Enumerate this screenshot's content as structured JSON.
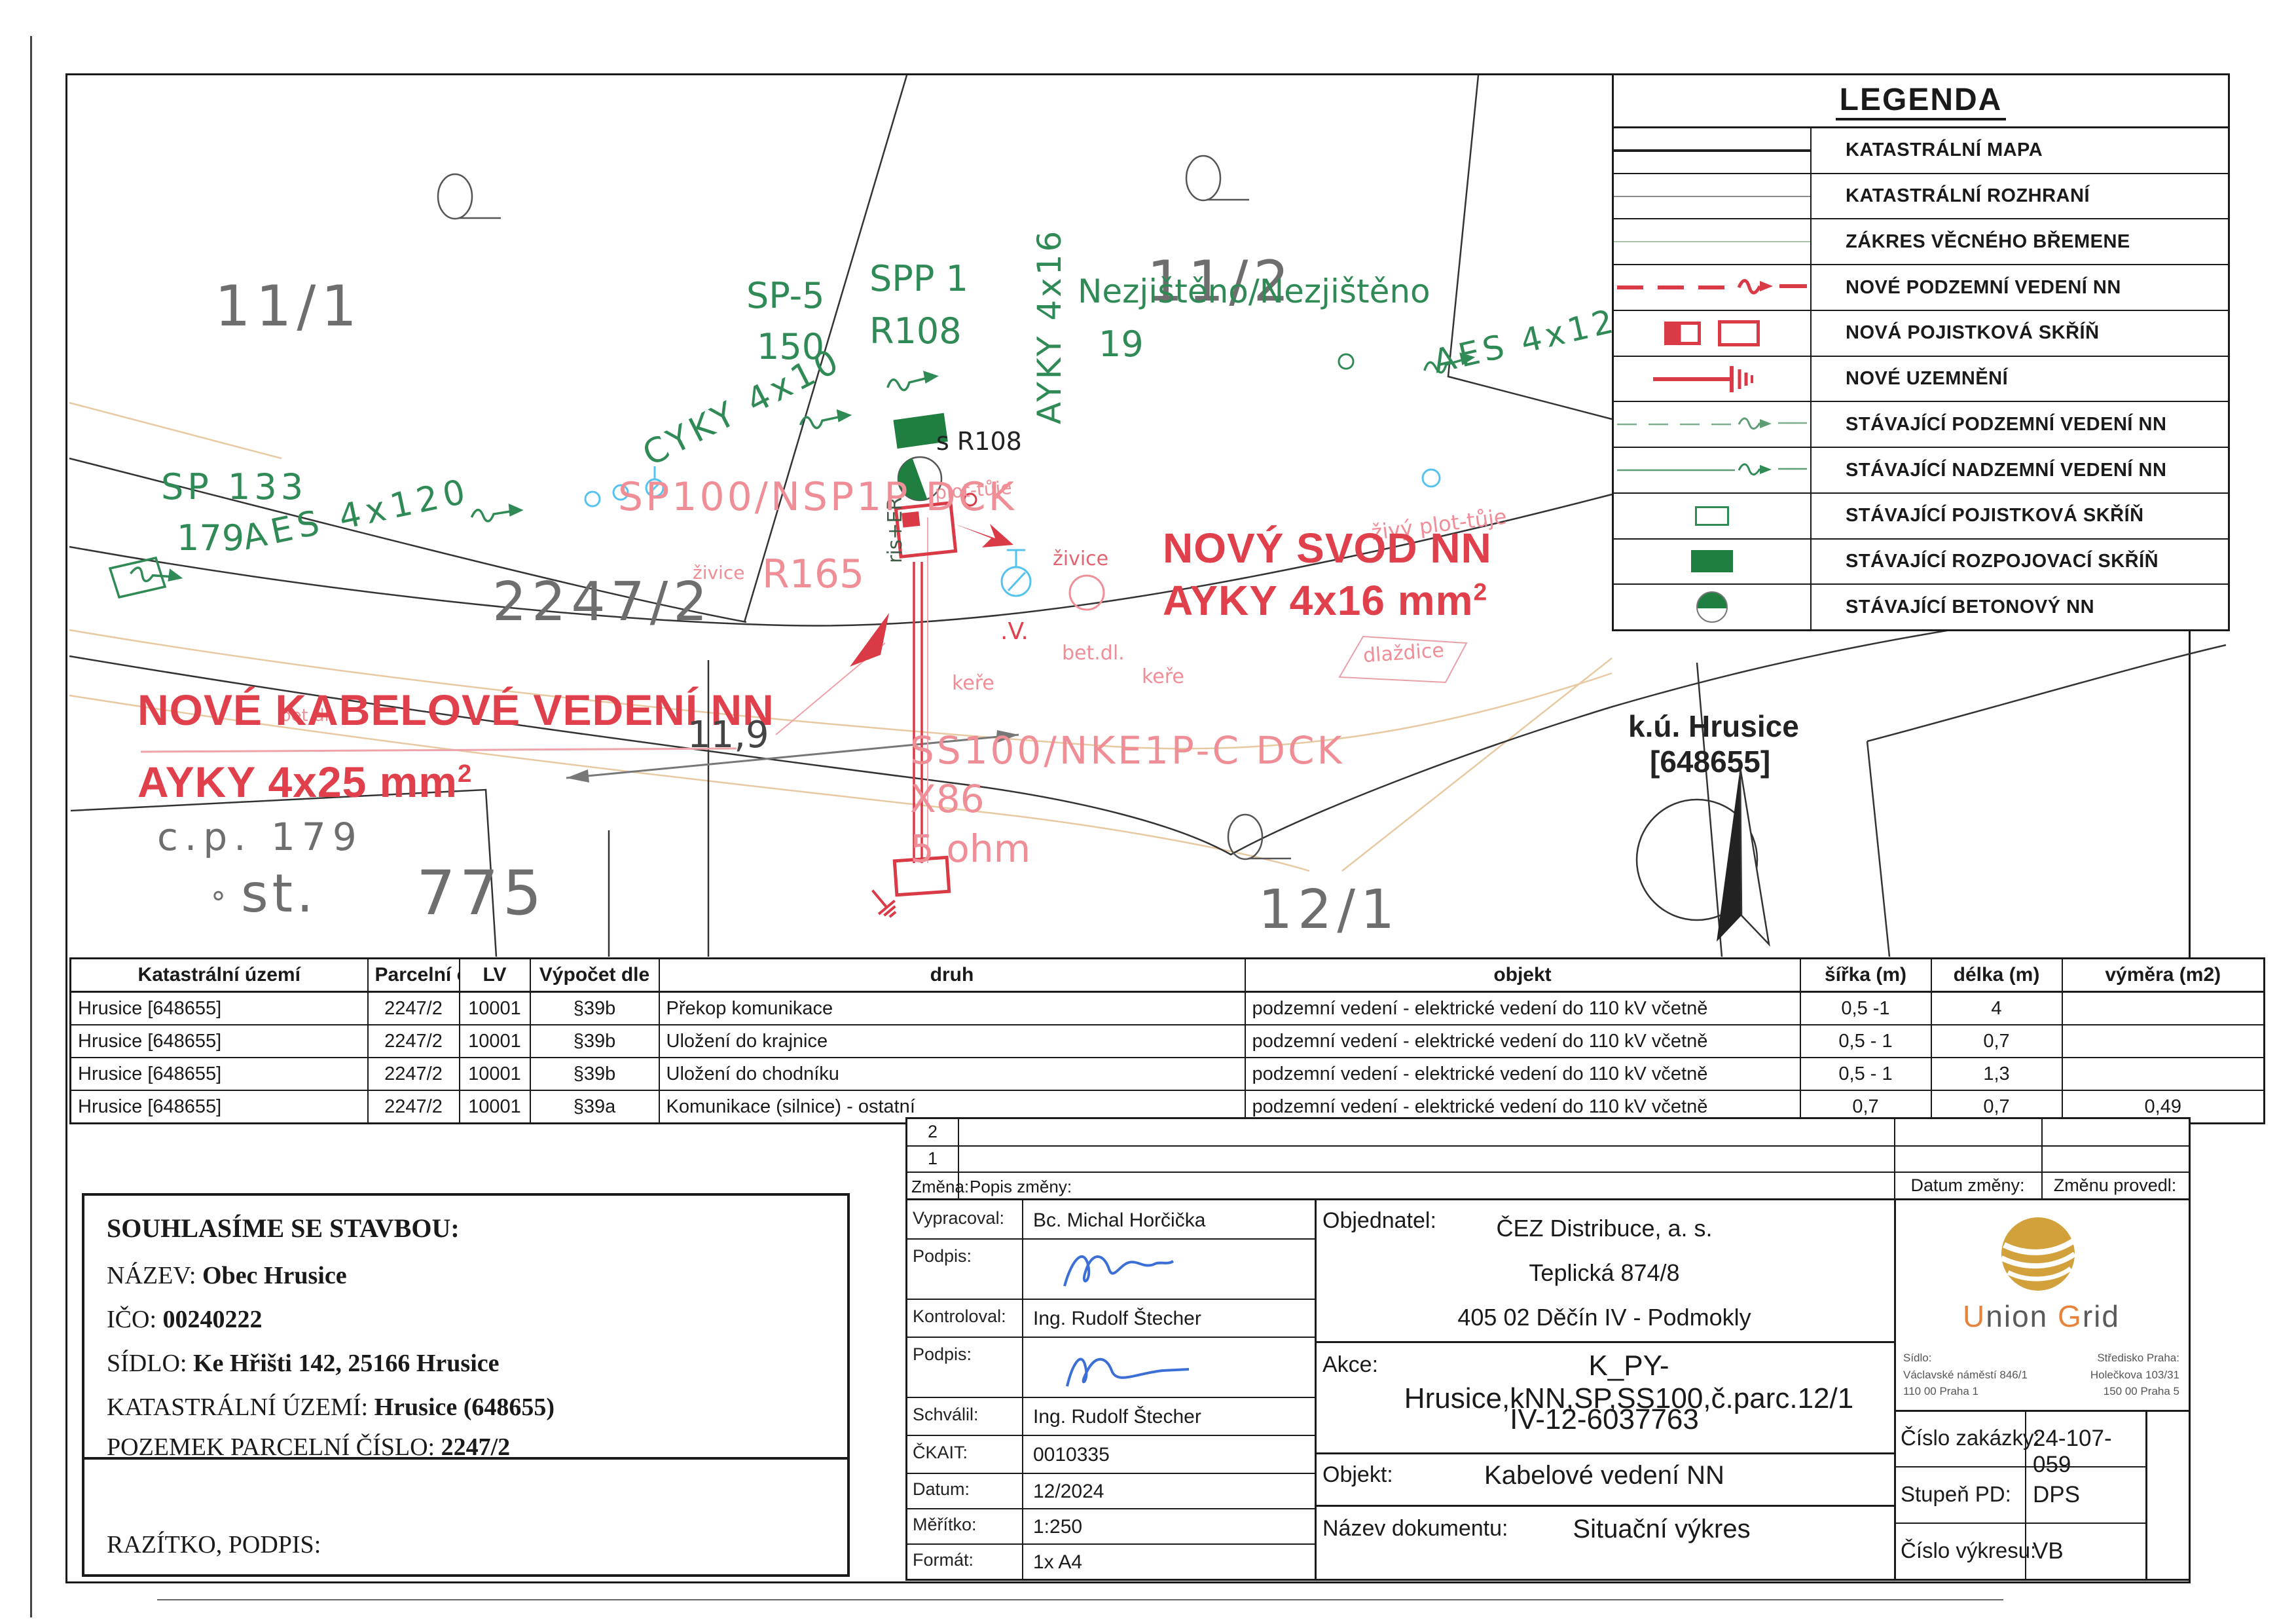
{
  "colors": {
    "new_red": "#d93a46",
    "existing_green": "#2f8a56",
    "pink_note": "#ef8e96",
    "annotation_red": "#e0404b",
    "signature_blue": "#3b6fd6",
    "logo_gold": "#d2a13c",
    "logo_orange": "#e8833a"
  },
  "legend": {
    "title": "LEGENDA",
    "items": [
      {
        "label": "KATASTRÁLNÍ MAPA",
        "symbol": "black-solid-line"
      },
      {
        "label": "KATASTRÁLNÍ ROZHRANÍ",
        "symbol": "gray-thin-line"
      },
      {
        "label": "ZÁKRES VĚCNÉHO BŘEMENE",
        "symbol": "light-green-line"
      },
      {
        "label": "NOVÉ PODZEMNÍ VEDENÍ NN",
        "symbol": "red-dashed-arrow-line"
      },
      {
        "label": "NOVÁ POJISTKOVÁ SKŘÍŇ",
        "symbol": "red-boxes"
      },
      {
        "label": "NOVÉ UZEMNĚNÍ",
        "symbol": "red-ground-symbol"
      },
      {
        "label": "STÁVAJÍCÍ PODZEMNÍ VEDENÍ NN",
        "symbol": "green-dashed-arrow-line"
      },
      {
        "label": "STÁVAJÍCÍ NADZEMNÍ VEDENÍ NN",
        "symbol": "green-solid-arrow-line"
      },
      {
        "label": "STÁVAJÍCÍ POJISTKOVÁ SKŘÍŇ",
        "symbol": "green-outline-box"
      },
      {
        "label": "STÁVAJÍCÍ ROZPOJOVACÍ SKŘÍŇ",
        "symbol": "green-filled-box"
      },
      {
        "label": "STÁVAJÍCÍ BETONOVÝ NN",
        "symbol": "green-half-circle"
      }
    ]
  },
  "map": {
    "parcels": {
      "p11_1": "11/1",
      "p11_2": "11/2",
      "p2247_2": "2247/2",
      "p12_1": "12/1",
      "cp179": "c.p. 179",
      "deg": "°",
      "st": "st.",
      "st775": "775"
    },
    "green": {
      "sp133": "SP 133",
      "n179": "179",
      "aes4x120": "AES 4x120",
      "cyky": "CYKY 4x10",
      "sp5": "SP-5",
      "n150": "150",
      "spp1": "SPP 1",
      "r108": "R108",
      "ayky4x16_v": "AYKY 4x16",
      "nezjisteno": "Nezjištěno/Nezjištěno",
      "n19": "19",
      "aes4x12": "AES 4x12",
      "riser": "ris+ER",
      "s_r108": "s R108"
    },
    "pink": {
      "sp100": "SP100/NSP1P DCK",
      "r165": "R165",
      "zivice1": "živice",
      "zivice2": "živice",
      "plot_tuje1": "plot-tůje",
      "plot_tuje2": "živý plot-tůje",
      "betdl1": "bet.dl.",
      "betdl2": "bet.dl.",
      "kere1": "keře",
      "kere2": "keře",
      "dlazdice": "dlaždice",
      "ss100": "SS100/NKE1P-C DCK",
      "x86": "X86",
      "ohm": "5 ohm",
      "v_mark": ".V."
    },
    "red": {
      "novy_svod_1": "NOVÝ SVOD NN",
      "novy_svod_2": "AYKY 4x16 mm",
      "nove_kabel_1": "NOVÉ KABELOVÉ VEDENÍ NN",
      "nove_kabel_2": "AYKY 4x25 mm",
      "sup": "2"
    },
    "dimension": "11,9",
    "north": {
      "line1": "k.ú. Hrusice",
      "line2": "[648655]"
    }
  },
  "surface_table": {
    "headers": [
      "Katastrální území",
      "Parcelní číslo",
      "LV",
      "Výpočet dle",
      "druh",
      "objekt",
      "šířka (m)",
      "délka (m)",
      "výměra (m2)"
    ],
    "rows": [
      [
        "Hrusice [648655]",
        "2247/2",
        "10001",
        "§39b",
        "Překop komunikace",
        "podzemní vedení - elektrické vedení do 110 kV včetně",
        "0,5 -1",
        "4",
        ""
      ],
      [
        "Hrusice [648655]",
        "2247/2",
        "10001",
        "§39b",
        "Uložení do krajnice",
        "podzemní vedení - elektrické vedení do 110 kV včetně",
        "0,5 - 1",
        "0,7",
        ""
      ],
      [
        "Hrusice [648655]",
        "2247/2",
        "10001",
        "§39b",
        "Uložení do chodníku",
        "podzemní vedení - elektrické vedení do 110 kV včetně",
        "0,5 - 1",
        "1,3",
        ""
      ],
      [
        "Hrusice [648655]",
        "2247/2",
        "10001",
        "§39a",
        "Komunikace (silnice) - ostatní",
        "podzemní vedení - elektrické vedení do 110 kV včetně",
        "0,7",
        "0,7",
        "0,49"
      ]
    ]
  },
  "consent": {
    "heading": "SOUHLASÍME SE STAVBOU:",
    "nazev_label": "NÁZEV:",
    "nazev": "Obec Hrusice",
    "ico_label": "IČO:",
    "ico": "00240222",
    "sidlo_label": "SÍDLO:",
    "sidlo": "Ke Hřišti 142, 25166 Hrusice",
    "ku_label": "KATASTRÁLNÍ ÚZEMÍ:",
    "ku": "Hrusice (648655)",
    "pozemek_label": "POZEMEK PARCELNÍ ČÍSLO:",
    "pozemek": "2247/2",
    "razitko": "RAZÍTKO, PODPIS:"
  },
  "revision": {
    "row2": "2",
    "row1": "1",
    "zmena": "Změna:",
    "popis": "Popis změny:",
    "datum_zmeny": "Datum změny:",
    "zmenu_provedl": "Změnu provedl:"
  },
  "title_block": {
    "vypracoval_label": "Vypracoval:",
    "vypracoval": "Bc. Michal Horčička",
    "podpis_label": "Podpis:",
    "kontroloval_label": "Kontroloval:",
    "kontroloval": "Ing. Rudolf Štecher",
    "podpis2_label": "Podpis:",
    "schvalil_label": "Schválil:",
    "schvalil": "Ing. Rudolf Štecher",
    "ckait_label": "ČKAIT:",
    "ckait": "0010335",
    "datum_label": "Datum:",
    "datum": "12/2024",
    "meritko_label": "Měřítko:",
    "meritko": "1:250",
    "format_label": "Formát:",
    "format": "1x A4",
    "objednatel_label": "Objednatel:",
    "objednatel_1": "ČEZ Distribuce,  a. s.",
    "objednatel_2": "Teplická 874/8",
    "objednatel_3": "405 02 Děčín IV - Podmokly",
    "akce_label": "Akce:",
    "akce_1": "K_PY-Hrusice,kNN,SP,SS100,č.parc.12/1",
    "akce_2": "IV-12-6037763",
    "objekt_label": "Objekt:",
    "objekt": "Kabelové vedení NN",
    "nazev_dok_label": "Název dokumentu:",
    "nazev_dok": "Situační výkres"
  },
  "company": {
    "name_u": "U",
    "name_rest1": "nion ",
    "name_g": "G",
    "name_rest2": "rid",
    "sidlo_label": "Sídlo:",
    "sidlo_1": "Václavské náměstí 846/1",
    "sidlo_2": "110 00 Praha 1",
    "stredisko_label": "Středisko Praha:",
    "stredisko_1": "Holečkova 103/31",
    "stredisko_2": "150 00 Praha 5"
  },
  "fields": {
    "zakazka_label": "Číslo zakázky:",
    "zakazka": "24-107-059",
    "stupen_label": "Stupeň PD:",
    "stupen": "DPS",
    "vykres_label": "Číslo výkresu:",
    "vykres": "VB"
  }
}
